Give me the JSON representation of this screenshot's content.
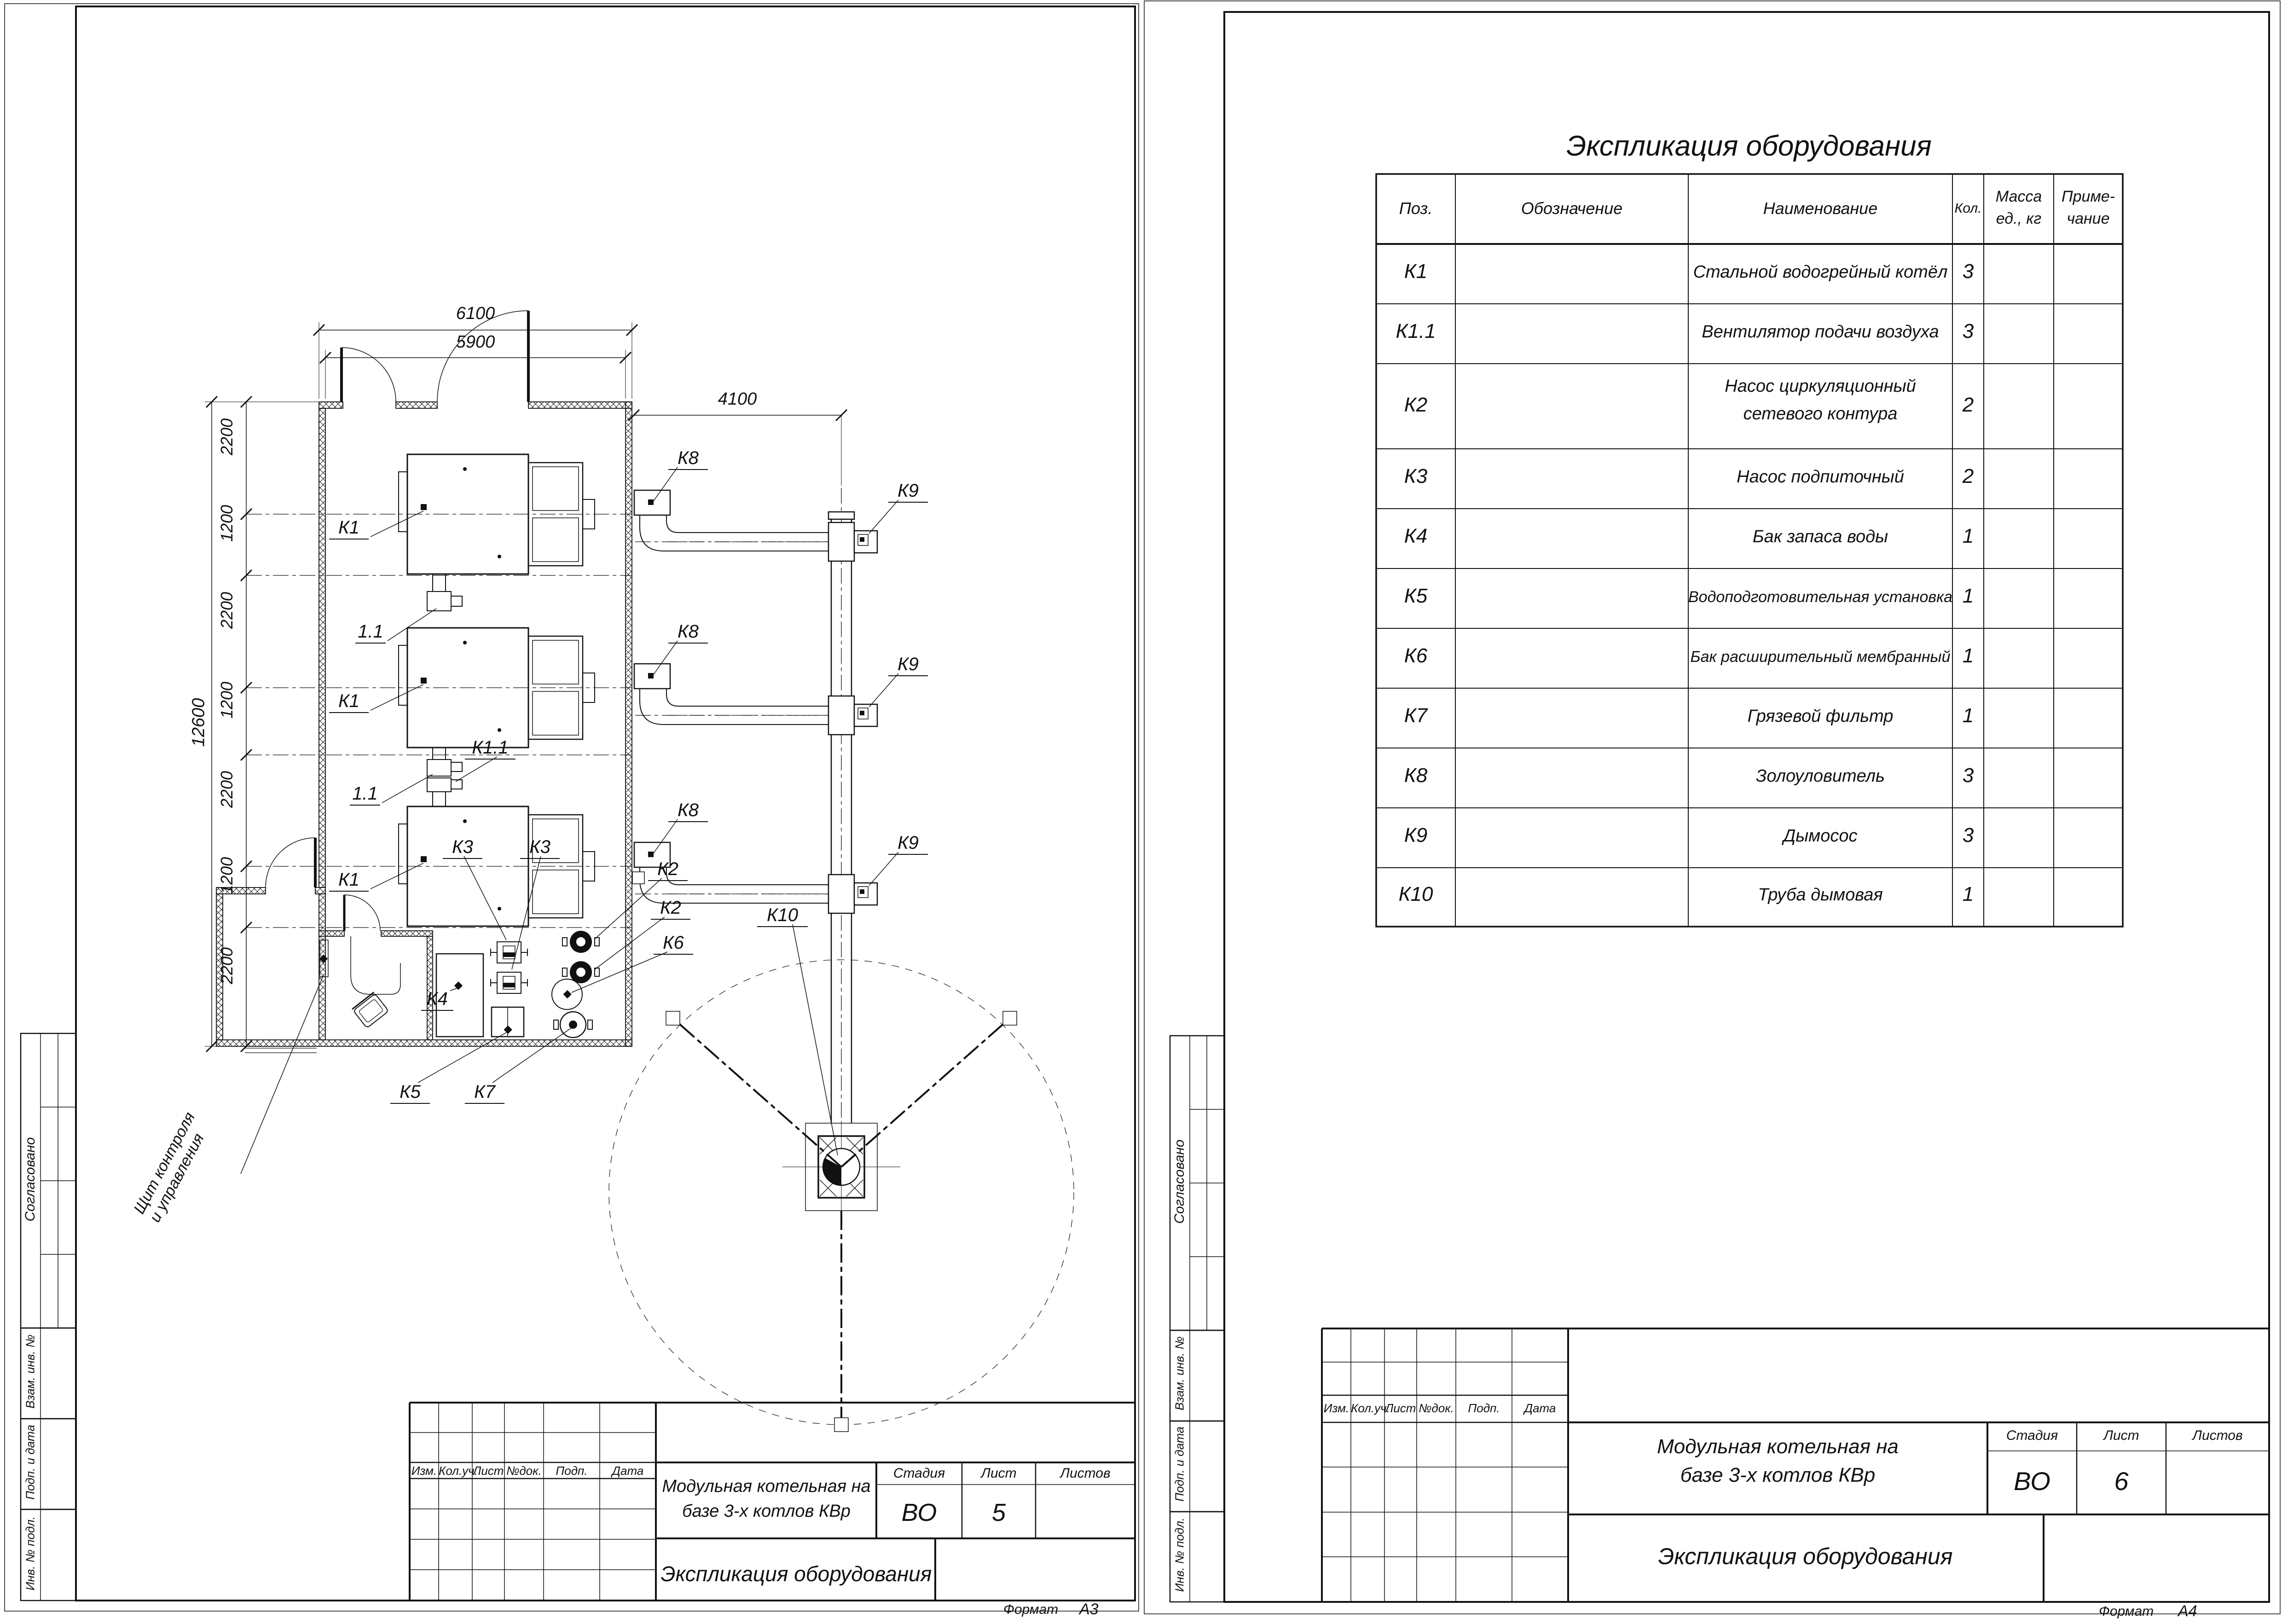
{
  "left_sheet": {
    "format_label": "Формат",
    "format_value": "А3",
    "margin_labels": [
      "Согласовано",
      "Взам. инв. №",
      "Подп. и дата",
      "Инв. № подл."
    ],
    "titleblock": {
      "rev_headers": [
        "Изм.",
        "Кол.уч.",
        "Лист",
        "№док.",
        "Подп.",
        "Дата"
      ],
      "stage_label": "Стадия",
      "sheet_label": "Лист",
      "sheets_label": "Листов",
      "stage": "ВО",
      "sheet_no": "5",
      "project_line1": "Модульная котельная на",
      "project_line2": "базе 3-х котлов КВр",
      "doc_title": "Экспликация оборудования"
    },
    "plan": {
      "dim_top_outer": "6100",
      "dim_top_inner": "5900",
      "dim_right": "4100",
      "dim_left_overall": "12600",
      "dim_chain": [
        "2200",
        "1200",
        "2200",
        "1200",
        "2200",
        "1200",
        "2200"
      ],
      "labels": {
        "boiler": "К1",
        "fan": "К1.1",
        "burner": "1.1",
        "pump_net": "К2",
        "pump_feed": "К3",
        "tank": "К4",
        "water_unit": "К5",
        "exp_tank": "К6",
        "filter": "К7",
        "ash": "К8",
        "smoke": "К9",
        "chimney": "К10"
      },
      "panel_label_line1": "Щит контроля",
      "panel_label_line2": "и управления"
    }
  },
  "right_sheet": {
    "format_label": "Формат",
    "format_value": "А4",
    "margin_labels": [
      "Согласовано",
      "Взам. инв. №",
      "Подп. и дата",
      "Инв. № подл."
    ],
    "table": {
      "title": "Экспликация оборудования",
      "col_pos": "Поз.",
      "col_design": "Обозначение",
      "col_name": "Наименование",
      "col_qty": "Кол.",
      "col_mass_l1": "Масса",
      "col_mass_l2": "ед., кг",
      "col_note_l1": "Приме-",
      "col_note_l2": "чание",
      "rows": [
        {
          "pos": "К1",
          "name": "Стальной водогрейный котёл",
          "qty": "3"
        },
        {
          "pos": "К1.1",
          "name": "Вентилятор подачи воздуха",
          "qty": "3"
        },
        {
          "pos": "К2",
          "name_l1": "Насос циркуляционный",
          "name_l2": "сетевого контура",
          "qty": "2"
        },
        {
          "pos": "К3",
          "name": "Насос подпиточный",
          "qty": "2"
        },
        {
          "pos": "К4",
          "name": "Бак запаса воды",
          "qty": "1"
        },
        {
          "pos": "К5",
          "name": "Водоподготовительная установка",
          "qty": "1"
        },
        {
          "pos": "К6",
          "name": "Бак расширительный мембранный",
          "qty": "1"
        },
        {
          "pos": "К7",
          "name": "Грязевой фильтр",
          "qty": "1"
        },
        {
          "pos": "К8",
          "name": "Золоуловитель",
          "qty": "3"
        },
        {
          "pos": "К9",
          "name": "Дымосос",
          "qty": "3"
        },
        {
          "pos": "К10",
          "name": "Труба дымовая",
          "qty": "1"
        }
      ]
    },
    "titleblock": {
      "rev_headers": [
        "Изм.",
        "Кол.уч.",
        "Лист",
        "№док.",
        "Подп.",
        "Дата"
      ],
      "stage_label": "Стадия",
      "sheet_label": "Лист",
      "sheets_label": "Листов",
      "stage": "ВО",
      "sheet_no": "6",
      "project_line1": "Модульная котельная на",
      "project_line2": "базе 3-х котлов КВр",
      "doc_title": "Экспликация оборудования"
    }
  }
}
